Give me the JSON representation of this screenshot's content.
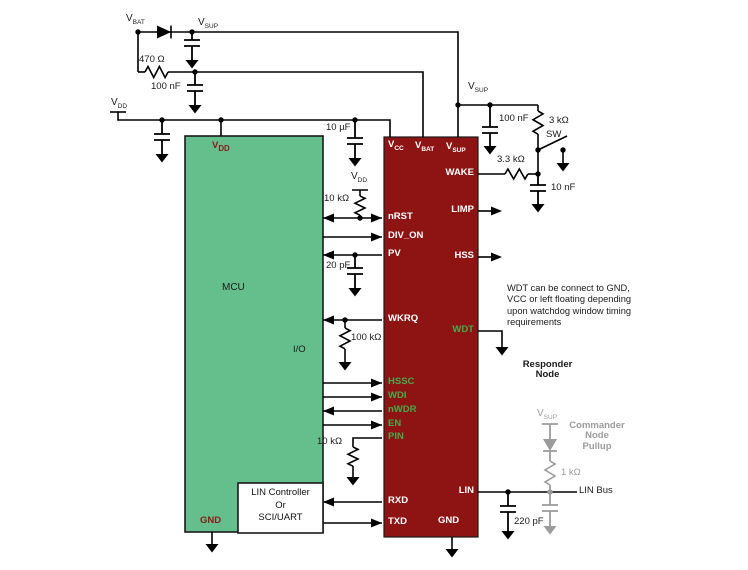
{
  "labels": {
    "vbat_top": {
      "main": "V",
      "sub": "BAT"
    },
    "vsup_top": {
      "main": "V",
      "sub": "SUP"
    },
    "vdd_rail": {
      "main": "V",
      "sub": "DD"
    },
    "vsup_ic": {
      "main": "V",
      "sub": "SUP"
    },
    "vdd_pullup": {
      "main": "V",
      "sub": "DD"
    },
    "vsup_commander": {
      "main": "V",
      "sub": "SUP"
    }
  },
  "components": {
    "r470": "470 Ω",
    "c100n_left": "100 nF",
    "c10u": "10 µF",
    "r10k_nrst": "10 kΩ",
    "c20p": "20 pF",
    "r100k": "100 kΩ",
    "r10k_pin": "10 kΩ",
    "c100n_right": "100 nF",
    "r3k": "3 kΩ",
    "sw": "SW",
    "r3_3k": "3.3 kΩ",
    "c10n": "10 nF",
    "r1k": "1 kΩ",
    "c220p": "220 pF"
  },
  "mcu": {
    "name": "MCU",
    "io": "I/O",
    "vdd": {
      "main": "V",
      "sub": "DD"
    },
    "gnd": "GND"
  },
  "lin_controller": {
    "line1": "LIN Controller",
    "line2": "Or",
    "line3": "SCI/UART"
  },
  "ic": {
    "top_pins": {
      "vcc": {
        "main": "V",
        "sub": "CC"
      },
      "vbat": {
        "main": "V",
        "sub": "BAT"
      },
      "vsup": {
        "main": "V",
        "sub": "SUP"
      }
    },
    "pins": {
      "nrst": "nRST",
      "div_on": "DIV_ON",
      "pv": "PV",
      "wkrq": "WKRQ",
      "hssc": "HSSC",
      "wdi": "WDI",
      "nwdr": "nWDR",
      "en": "EN",
      "pin": "PIN",
      "rxd": "RXD",
      "txd": "TXD",
      "wake": "WAKE",
      "limp": "LIMP",
      "hss": "HSS",
      "wdt": "WDT",
      "lin": "LIN",
      "gnd": "GND"
    }
  },
  "notes": {
    "wdt_l1": "WDT can be connect to GND,",
    "wdt_l2": "VCC or left floating depending",
    "wdt_l3": "upon watchdog window timing",
    "wdt_l4": "requirements",
    "responder_l1": "Responder",
    "responder_l2": "Node",
    "commander_l1": "Commander",
    "commander_l2": "Node",
    "commander_l3": "Pullup",
    "lin_bus": "LIN Bus"
  },
  "colors": {
    "mcu_green": "#64BF8D",
    "ic_red": "#8E1414",
    "pin_green": "#44AB4D",
    "block_label_maroon": "#8B1A1A",
    "commander_gray": "#9B9B9B",
    "wire_black": "#000000"
  }
}
